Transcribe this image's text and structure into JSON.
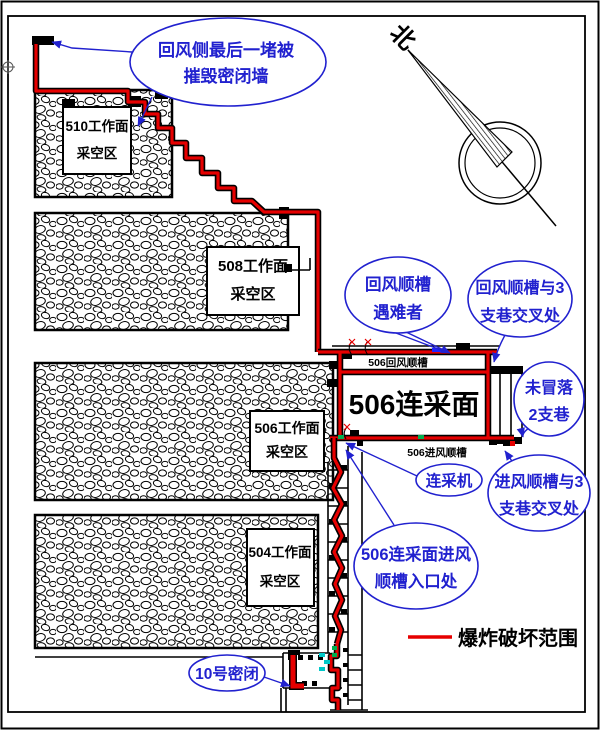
{
  "colors": {
    "damage": "#e60000",
    "callout": "#2121cf",
    "green": "#00b050",
    "cyan": "#00c8c8",
    "bluemark": "#2020ff"
  },
  "north": {
    "label": "北"
  },
  "legend": {
    "label": "爆炸破坏范围",
    "symbol": "red-line"
  },
  "face": {
    "title": "506连采面",
    "return_airway_label": "506回风顺槽",
    "intake_airway_label": "506进风顺槽"
  },
  "goafs": [
    {
      "id": "510",
      "line1": "510工作面",
      "line2": "采空区"
    },
    {
      "id": "508",
      "line1": "508工作面",
      "line2": "采空区"
    },
    {
      "id": "506",
      "line1": "506工作面",
      "line2": "采空区"
    },
    {
      "id": "504",
      "line1": "504工作面",
      "line2": "采空区"
    }
  ],
  "callouts": {
    "destroyed_wall": {
      "line1": "回风侧最后一堵被",
      "line2": "摧毁密闭墙"
    },
    "victims": {
      "line1": "回风顺槽",
      "line2": "遇难者"
    },
    "return_junction": {
      "line1": "回风顺槽与3",
      "line2": "支巷交叉处"
    },
    "uncollapsed": {
      "line1": "未冒落",
      "line2": "2支巷"
    },
    "intake_junction": {
      "line1": "进风顺槽与3",
      "line2": "支巷交叉处"
    },
    "miner": {
      "label": "连采机"
    },
    "intake_entrance": {
      "line1": "506连采面进风",
      "line2": "顺槽入口处"
    },
    "seal_10": {
      "label": "10号密闭"
    }
  }
}
